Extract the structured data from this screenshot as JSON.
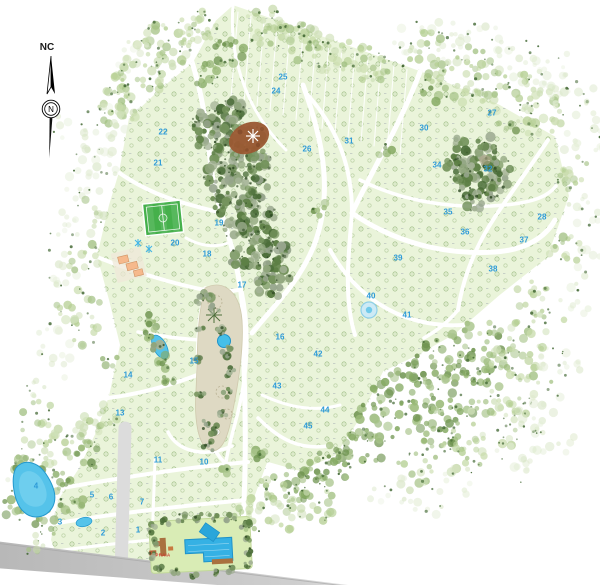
{
  "compass": {
    "label": "NC",
    "north_letter": "N"
  },
  "colors": {
    "lot_green": "#eaf4da",
    "road_white": "#ffffff",
    "road_gray": "#dcdcdc",
    "band_gray": "#bdbdbd",
    "water_blue": "#55c3ea",
    "water_deep": "#2498cd",
    "field_green": "#45b04b",
    "clearing_brown": "#9a5a33",
    "building_orange": "#f6b98c",
    "deck_brown": "#a9713f",
    "park_tan": "#ded9c3",
    "label_blue": "#2e9bd8",
    "praia_red": "#d0342c",
    "tree_dark": "#4c6e3a",
    "tree_mid": "#86aa64",
    "tree_light": "#c7dba9"
  },
  "map": {
    "block_labels": [
      {
        "n": "1",
        "x": 138,
        "y": 530
      },
      {
        "n": "2",
        "x": 103,
        "y": 533
      },
      {
        "n": "3",
        "x": 60,
        "y": 522
      },
      {
        "n": "4",
        "x": 36,
        "y": 486
      },
      {
        "n": "5",
        "x": 92,
        "y": 495
      },
      {
        "n": "6",
        "x": 111,
        "y": 497
      },
      {
        "n": "7",
        "x": 142,
        "y": 502
      },
      {
        "n": "10",
        "x": 204,
        "y": 462
      },
      {
        "n": "11",
        "x": 158,
        "y": 460
      },
      {
        "n": "13",
        "x": 120,
        "y": 413
      },
      {
        "n": "14",
        "x": 128,
        "y": 375
      },
      {
        "n": "15",
        "x": 194,
        "y": 361
      },
      {
        "n": "16",
        "x": 280,
        "y": 337
      },
      {
        "n": "17",
        "x": 242,
        "y": 285
      },
      {
        "n": "18",
        "x": 207,
        "y": 254
      },
      {
        "n": "19",
        "x": 219,
        "y": 223
      },
      {
        "n": "20",
        "x": 175,
        "y": 243
      },
      {
        "n": "21",
        "x": 158,
        "y": 163
      },
      {
        "n": "22",
        "x": 163,
        "y": 132
      },
      {
        "n": "24",
        "x": 276,
        "y": 91
      },
      {
        "n": "25",
        "x": 283,
        "y": 77
      },
      {
        "n": "26",
        "x": 307,
        "y": 149
      },
      {
        "n": "27",
        "x": 492,
        "y": 113
      },
      {
        "n": "28",
        "x": 542,
        "y": 217
      },
      {
        "n": "30",
        "x": 424,
        "y": 128
      },
      {
        "n": "31",
        "x": 349,
        "y": 141
      },
      {
        "n": "32",
        "x": 488,
        "y": 169
      },
      {
        "n": "34",
        "x": 437,
        "y": 165
      },
      {
        "n": "35",
        "x": 448,
        "y": 212
      },
      {
        "n": "36",
        "x": 465,
        "y": 232
      },
      {
        "n": "37",
        "x": 524,
        "y": 240
      },
      {
        "n": "38",
        "x": 493,
        "y": 269
      },
      {
        "n": "39",
        "x": 398,
        "y": 258
      },
      {
        "n": "40",
        "x": 371,
        "y": 296
      },
      {
        "n": "41",
        "x": 407,
        "y": 315
      },
      {
        "n": "42",
        "x": 318,
        "y": 354
      },
      {
        "n": "43",
        "x": 277,
        "y": 386
      },
      {
        "n": "44",
        "x": 325,
        "y": 410
      },
      {
        "n": "45",
        "x": 308,
        "y": 426
      }
    ],
    "feature_labels": [
      {
        "text": "PRAIA",
        "x": 163,
        "y": 556
      }
    ]
  }
}
